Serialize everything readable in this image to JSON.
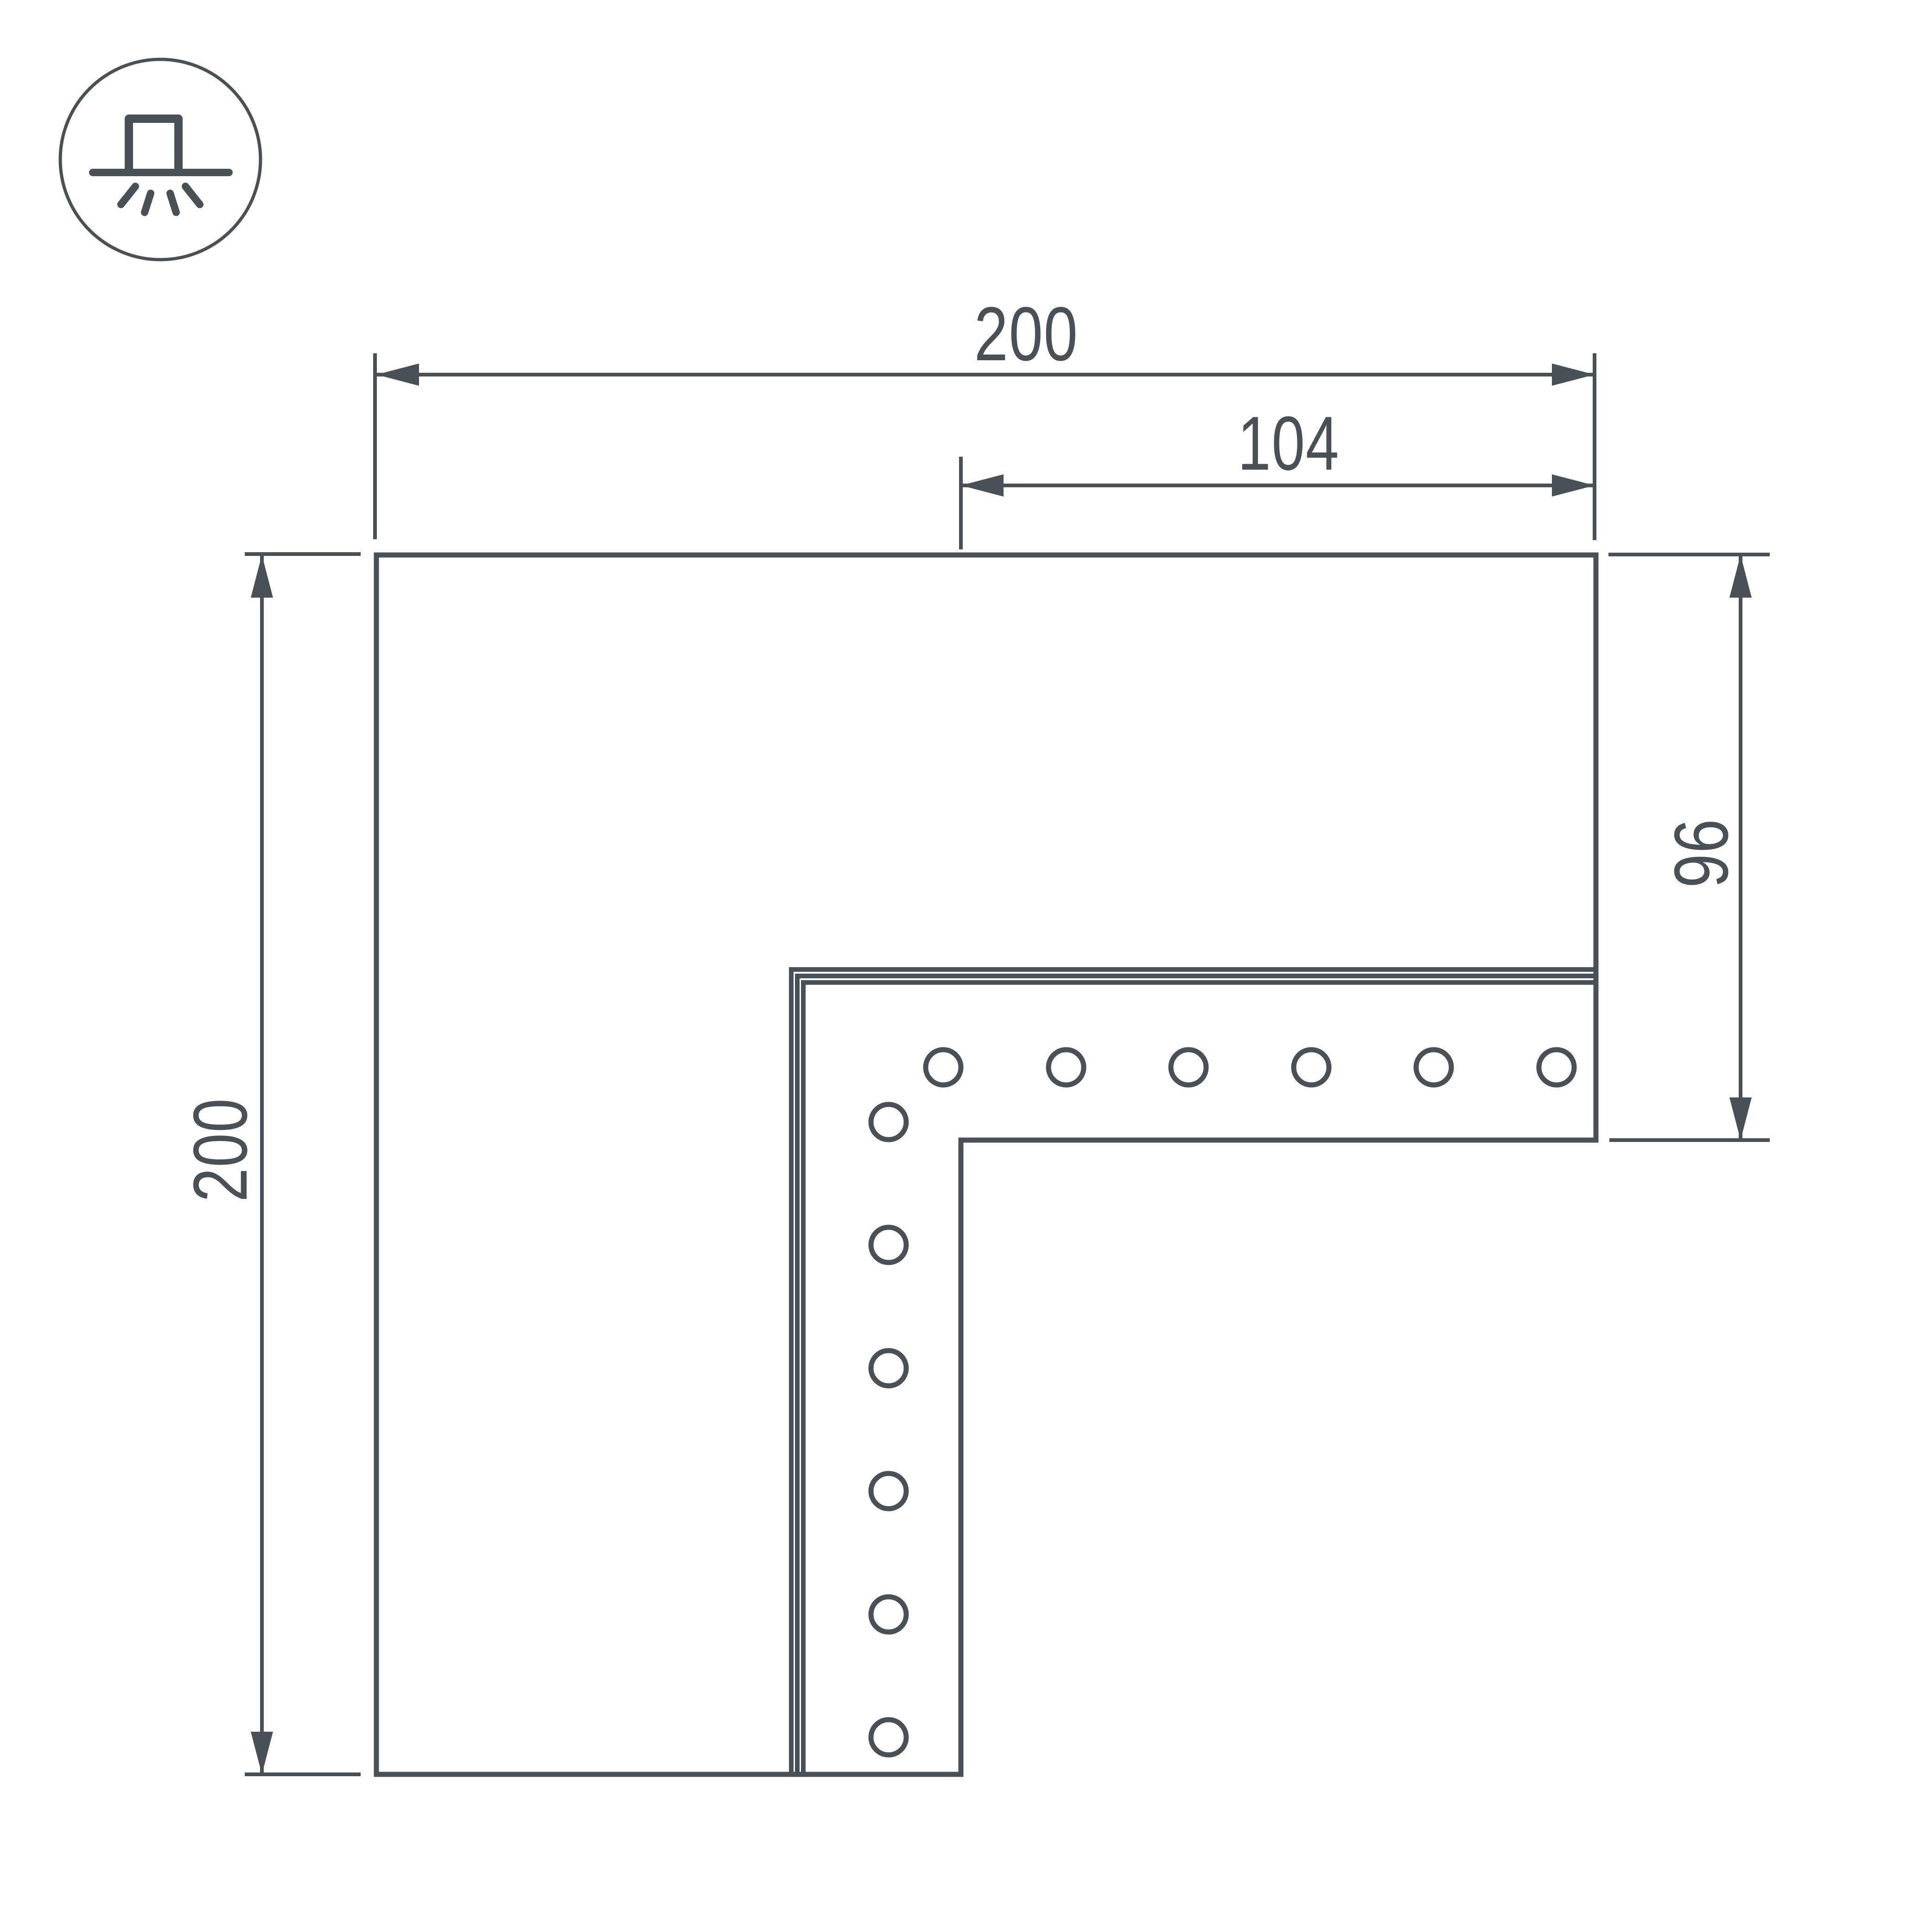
{
  "drawing": {
    "background": "#FFFFFF",
    "line_color": "#4A5156",
    "icon": "surface-mounted-luminaire-icon",
    "dimensions": {
      "top_width": "200",
      "inner_width": "104",
      "left_height": "200",
      "right_height": "96"
    },
    "holes": {
      "horizontal_row": 6,
      "vertical_column": 6
    }
  }
}
